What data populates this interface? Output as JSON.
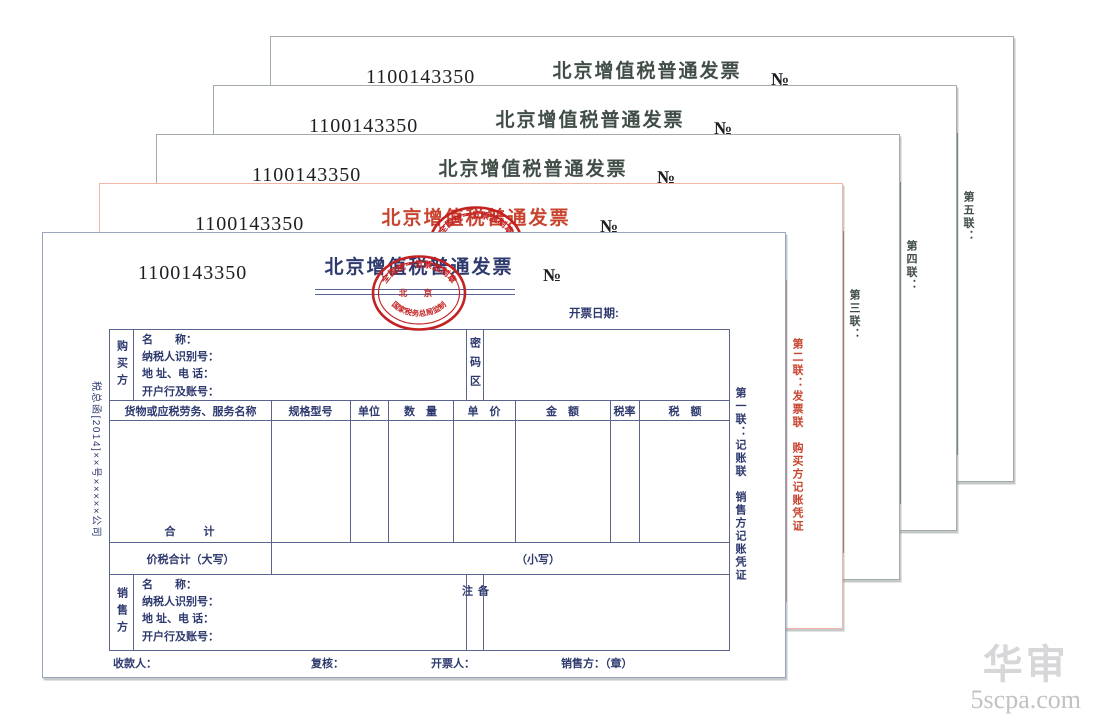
{
  "invoice": {
    "serial": "1100143350",
    "title": "北京增值税普通发票",
    "number_symbol": "№",
    "date_label": "开票日期:",
    "doc_ref": "税总函[2014]××号×××××公司",
    "stamp": {
      "top_arc": "全国统一发票监制章",
      "center": "北 京",
      "bottom_arc": "国家税务总局监制"
    },
    "buyer": {
      "label": "购买方",
      "rows": [
        "名　　称：",
        "纳税人识别号：",
        "地 址、电 话：",
        "开户行及账号："
      ],
      "password_label": "密码区"
    },
    "items": {
      "headers": [
        "货物或应税劳务、服务名称",
        "规格型号",
        "单位",
        "数　量",
        "单　价",
        "金　额",
        "税率",
        "税　额"
      ],
      "total_label": "合　　计"
    },
    "summary": {
      "words_label": "价税合计（大写）",
      "figures_label": "（小写）"
    },
    "seller": {
      "label": "销售方",
      "rows": [
        "名　　称：",
        "纳税人识别号：",
        "地 址、电 话：",
        "开户行及账号："
      ],
      "remark_label": "备注"
    },
    "footer": {
      "payee": "收款人：",
      "reviewer": "复核：",
      "drawer": "开票人：",
      "seller_seal": "销售方：（章）"
    },
    "copies": [
      {
        "label": "第一联：记账联　销售方记账凭证",
        "ink": "#2e3a6e",
        "line": "#5a648e",
        "border": "#9aa4ba",
        "has_stamp": true
      },
      {
        "label": "第二联：发票联　购买方记账凭证",
        "ink": "#c8442f",
        "line": "#dd8f7e",
        "border": "#f3b5a5",
        "has_stamp": true
      },
      {
        "label": "第三联：",
        "ink": "#414e47",
        "line": "#6d7872",
        "border": "#a4aca7",
        "has_stamp": false
      },
      {
        "label": "第四联：",
        "ink": "#414e47",
        "line": "#6d7872",
        "border": "#a4aca7",
        "has_stamp": false
      },
      {
        "label": "第五联：",
        "ink": "#414e47",
        "line": "#6d7872",
        "border": "#a4aca7",
        "has_stamp": false
      }
    ]
  },
  "colors": {
    "stamp_red": "#c42222",
    "serial_text": "#1d1d22",
    "watermark_cn": "#d7d7d9",
    "watermark_en": "#c2c2c4"
  },
  "watermark": {
    "line1": "华审",
    "line2": "5scpa.com"
  }
}
